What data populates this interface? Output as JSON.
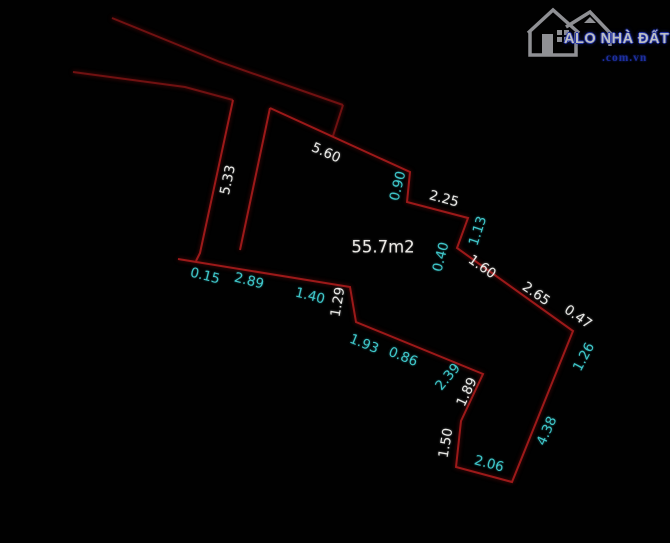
{
  "canvas": {
    "background": "#000000",
    "width": 670,
    "height": 543
  },
  "watermark": {
    "title": "ALO NHÀ ĐẤT",
    "domain": ".com.vn",
    "title_color": "#bcbfc4",
    "title_outline_color": "#2434a6",
    "domain_color": "#1d2f9f",
    "house_color": "#8f9094"
  },
  "parcel": {
    "area_label": "55.7m2",
    "line_color": "#9c1919",
    "road_line_color": "#701111",
    "dim_color_primary": "#e9e9e6",
    "dim_color_secondary": "#3fc6c9"
  },
  "dimensions": [
    {
      "value": "5.33",
      "x": 228,
      "y": 180,
      "rot": -78,
      "tone": "white"
    },
    {
      "value": "5.60",
      "x": 326,
      "y": 153,
      "rot": 24,
      "tone": "white"
    },
    {
      "value": "0.90",
      "x": 398,
      "y": 186,
      "rot": -76,
      "tone": "cyan"
    },
    {
      "value": "2.25",
      "x": 444,
      "y": 199,
      "rot": 15,
      "tone": "white"
    },
    {
      "value": "1.13",
      "x": 478,
      "y": 231,
      "rot": -72,
      "tone": "cyan"
    },
    {
      "value": "0.40",
      "x": 441,
      "y": 257,
      "rot": -76,
      "tone": "cyan"
    },
    {
      "value": "1.60",
      "x": 482,
      "y": 267,
      "rot": 35,
      "tone": "white"
    },
    {
      "value": "2.65",
      "x": 536,
      "y": 294,
      "rot": 35,
      "tone": "white"
    },
    {
      "value": "0.47",
      "x": 578,
      "y": 317,
      "rot": 35,
      "tone": "white"
    },
    {
      "value": "1.26",
      "x": 584,
      "y": 357,
      "rot": -62,
      "tone": "cyan"
    },
    {
      "value": "4.38",
      "x": 547,
      "y": 431,
      "rot": -66,
      "tone": "cyan"
    },
    {
      "value": "2.06",
      "x": 489,
      "y": 464,
      "rot": 15,
      "tone": "cyan"
    },
    {
      "value": "1.50",
      "x": 446,
      "y": 443,
      "rot": -80,
      "tone": "white"
    },
    {
      "value": "1.89",
      "x": 467,
      "y": 392,
      "rot": -65,
      "tone": "white"
    },
    {
      "value": "2.39",
      "x": 448,
      "y": 377,
      "rot": -50,
      "tone": "cyan"
    },
    {
      "value": "0.86",
      "x": 403,
      "y": 357,
      "rot": 22,
      "tone": "cyan"
    },
    {
      "value": "1.93",
      "x": 364,
      "y": 344,
      "rot": 22,
      "tone": "cyan"
    },
    {
      "value": "1.29",
      "x": 338,
      "y": 302,
      "rot": -80,
      "tone": "white"
    },
    {
      "value": "1.40",
      "x": 310,
      "y": 296,
      "rot": 14,
      "tone": "cyan"
    },
    {
      "value": "2.89",
      "x": 249,
      "y": 281,
      "rot": 14,
      "tone": "cyan"
    },
    {
      "value": "0.15",
      "x": 205,
      "y": 276,
      "rot": 14,
      "tone": "cyan"
    }
  ],
  "geometry": {
    "road_upper": [
      [
        112,
        18
      ],
      [
        220,
        62
      ],
      [
        343,
        105
      ]
    ],
    "road_lower": [
      [
        73,
        72
      ],
      [
        185,
        87
      ],
      [
        233,
        100
      ]
    ],
    "road_connector": [
      [
        343,
        105
      ],
      [
        333,
        136
      ]
    ],
    "strip_left": [
      [
        233,
        100
      ],
      [
        200,
        253
      ],
      [
        196,
        261
      ]
    ],
    "strip_right": [
      [
        270,
        108
      ],
      [
        240,
        250
      ]
    ],
    "boundary": [
      [
        270,
        108
      ],
      [
        410,
        172
      ],
      [
        407,
        202
      ],
      [
        468,
        218
      ],
      [
        457,
        248
      ],
      [
        573,
        331
      ],
      [
        512,
        482
      ],
      [
        456,
        467
      ],
      [
        461,
        421
      ],
      [
        483,
        374
      ],
      [
        356,
        322
      ],
      [
        350,
        287
      ],
      [
        178,
        259
      ]
    ]
  }
}
